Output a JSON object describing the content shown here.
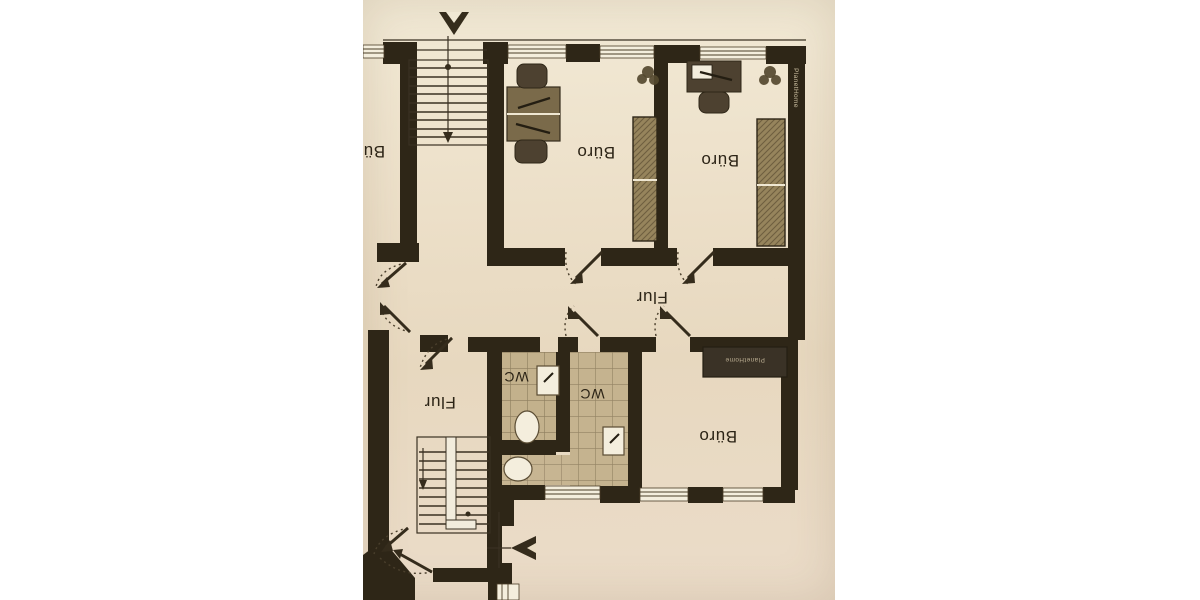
{
  "page": {
    "background": "#ffffff"
  },
  "floorplan": {
    "labels": {
      "office_top_left": "Büro",
      "office_top_middle": "Büro",
      "office_top_right": "Büro",
      "office_bottom_right": "Büro",
      "corridor_main": "Flur",
      "corridor_stair": "Flur",
      "wc_small": "WC",
      "wc_large": "WC"
    },
    "watermark_wall": "PlanetHome",
    "watermark_sideboard": "PlanetHome",
    "colors": {
      "page": "#ffffff",
      "paper": "#ebdfc9",
      "wall": "#2e2617",
      "ink": "#2c2416",
      "tile": "#c3b18c",
      "grout": "#8d7d5e",
      "furniture": "#96845c",
      "fixture": "#f4eedd"
    }
  }
}
